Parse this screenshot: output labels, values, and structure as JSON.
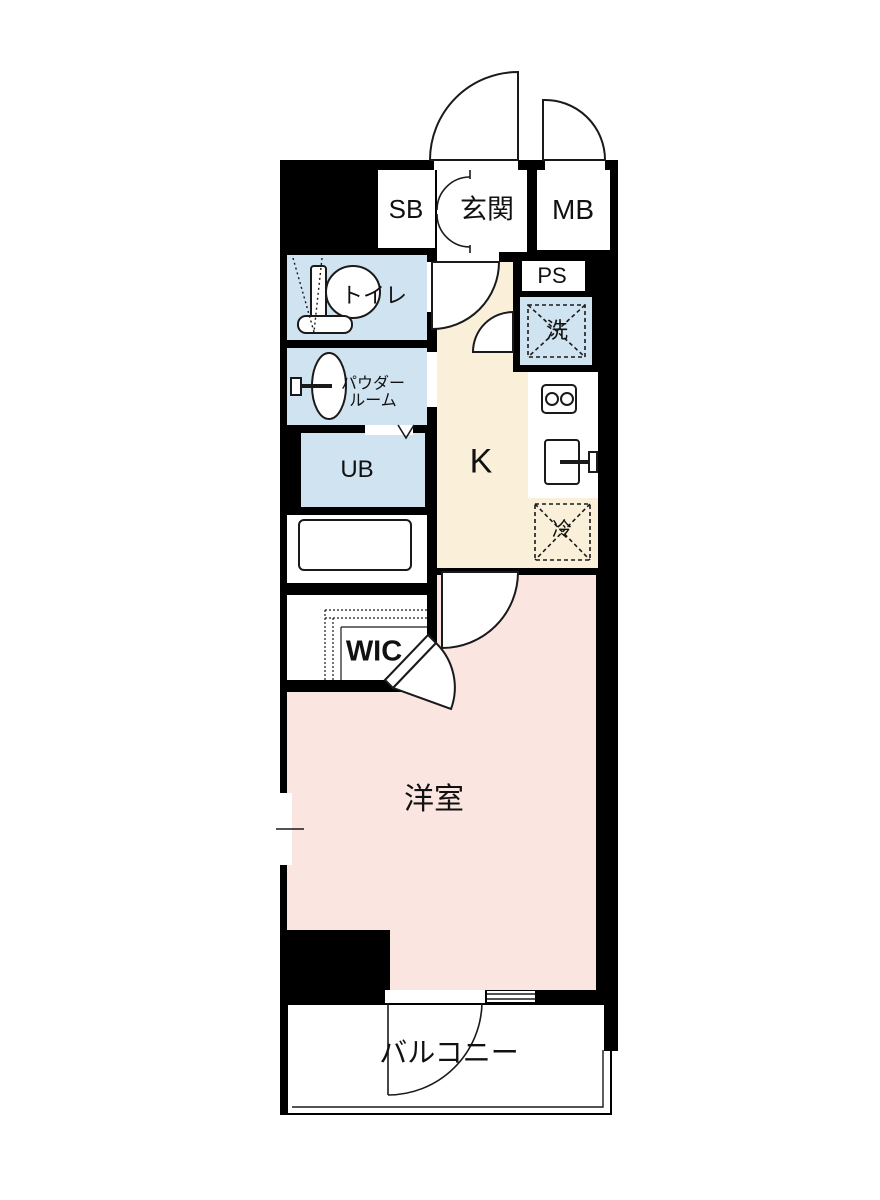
{
  "plan_type": "floorplan",
  "colors": {
    "wall": "#000000",
    "water_room_fill": "#cfe3f1",
    "kitchen_fill": "#faf0d9",
    "bedroom_fill": "#fbe5e1",
    "background": "#ffffff",
    "line": "#1a1a1a"
  },
  "rooms": {
    "sb": {
      "label": "SB"
    },
    "genkan": {
      "label": "玄関"
    },
    "mb": {
      "label": "MB"
    },
    "ps": {
      "label": "PS"
    },
    "washer": {
      "label": "洗"
    },
    "toilet": {
      "label": "トイレ"
    },
    "powder": {
      "line1": "パウダー",
      "line2": "ルーム"
    },
    "ub": {
      "label": "UB"
    },
    "kitchen": {
      "label": "K"
    },
    "fridge": {
      "label": "冷"
    },
    "wic": {
      "label": "WIC"
    },
    "bedroom": {
      "label": "洋室"
    },
    "balcony": {
      "label": "バルコニー"
    }
  },
  "icons": {
    "toilet_fixture": "toilet-icon",
    "powder_sink": "sink-icon",
    "bathtub": "bathtub-icon",
    "stove": "stove-icon",
    "kitchen_sink": "kitchen-sink-icon",
    "washer_space_cross": "washing-machine-space-icon",
    "fridge_space_cross": "refrigerator-space-icon",
    "door_swings": "door-swing-icon",
    "windows": "window-icon",
    "ub_door_mark": "folding-door-icon"
  }
}
